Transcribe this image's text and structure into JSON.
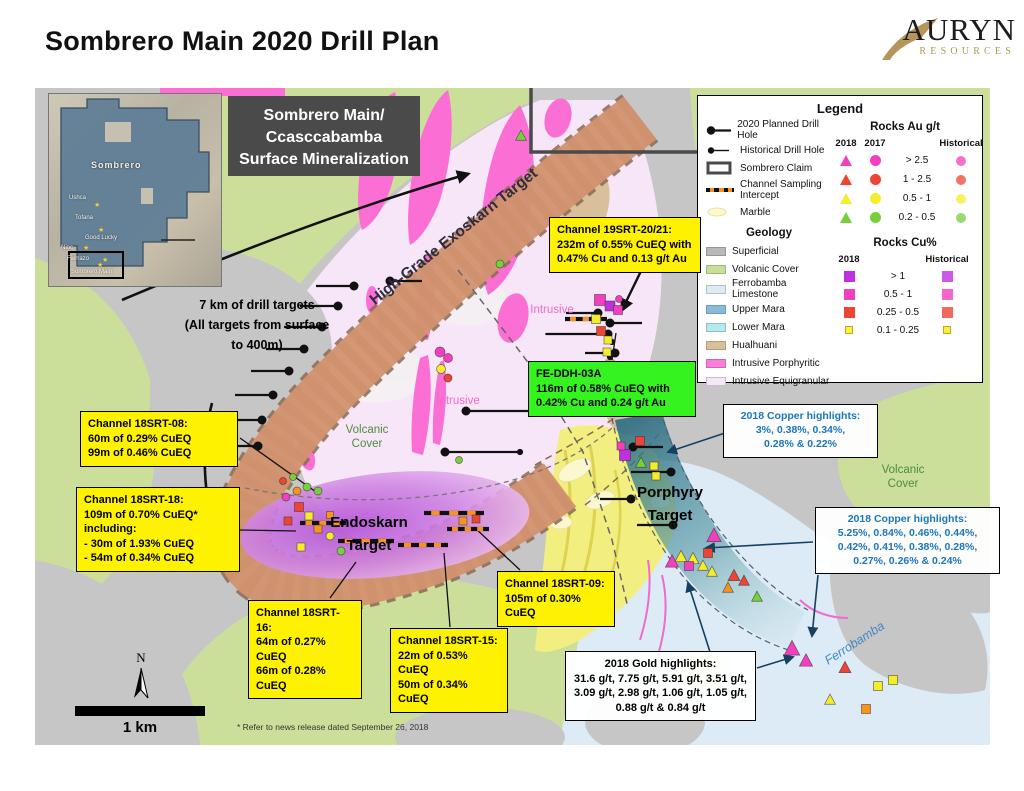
{
  "page": {
    "title": "Sombrero Main 2020 Drill Plan"
  },
  "logo": {
    "brand": "AURYN",
    "subtitle": "RESOURCES",
    "gold": "#b5955a"
  },
  "title_box": {
    "line1": "Sombrero Main/",
    "line2": "Ccasccabamba",
    "line3": "Surface Mineralization"
  },
  "inset": {
    "region": "Sombrero",
    "targets": [
      {
        "name": "Ushca",
        "lx": 20,
        "ly": 101,
        "sx": 45,
        "sy": 108
      },
      {
        "name": "Tofana",
        "lx": 26,
        "ly": 121,
        "sx": -1,
        "sy": -1
      },
      {
        "name": "Good Lucky",
        "lx": 36,
        "ly": 141,
        "sx": 49,
        "sy": 133
      },
      {
        "name": "Nioc",
        "lx": 12,
        "ly": 151,
        "sx": 34,
        "sy": 151
      },
      {
        "name": "Fierrazo",
        "lx": 18,
        "ly": 162,
        "sx": 53,
        "sy": 163
      },
      {
        "name": "Sombrero Main",
        "lx": 22,
        "ly": 175,
        "sx": 48,
        "sy": 168
      }
    ]
  },
  "legend": {
    "title": "Legend",
    "items": [
      {
        "label": "2020 Planned Drill Hole"
      },
      {
        "label": "Historical Drill Hole"
      },
      {
        "label": "Sombrero Claim"
      },
      {
        "label": "Channel Sampling Intercept"
      },
      {
        "label": "Marble"
      }
    ],
    "geology": {
      "title": "Geology",
      "items": [
        {
          "label": "Superficial",
          "color": "#b8b8b8"
        },
        {
          "label": "Volcanic Cover",
          "color": "#c9df97"
        },
        {
          "label": "Ferrobamba Limestone",
          "color": "#dcebf5"
        },
        {
          "label": "Upper Mara",
          "color": "#8abbdc"
        },
        {
          "label": "Lower Mara",
          "color": "#b5e8f0"
        },
        {
          "label": "Hualhuani",
          "color": "#d9c09b"
        },
        {
          "label": "Intrusive Porphyritic",
          "color": "#fb7edb"
        },
        {
          "label": "Intrusive Equigranular",
          "color": "#f7e6f8"
        }
      ]
    },
    "rocks_au": {
      "title": "Rocks Au g/t",
      "col_2018": "2018",
      "col_2017": "2017",
      "col_hist": "Historical",
      "rows": [
        {
          "range": "> 2.5",
          "color": "#f23fc0"
        },
        {
          "range": "1 - 2.5",
          "color": "#ee4433"
        },
        {
          "range": "0.5 - 1",
          "color": "#f6ee2c"
        },
        {
          "range": "0.2 - 0.5",
          "color": "#77cf3c"
        }
      ]
    },
    "rocks_cu": {
      "title": "Rocks Cu%",
      "col_2018": "2018",
      "col_hist": "Historical",
      "rows": [
        {
          "range": "> 1",
          "color": "#c02fe0"
        },
        {
          "range": "0.5 - 1",
          "color": "#f23fc0"
        },
        {
          "range": "0.25 - 0.5",
          "color": "#ee4433"
        },
        {
          "range": "0.1 - 0.25",
          "color": "#f6ee2c"
        }
      ]
    }
  },
  "callouts": {
    "ch19": {
      "lines": [
        "Channel 19SRT-20/21:",
        "232m of 0.55% CuEQ with",
        "0.47% Cu and 0.13 g/t Au"
      ]
    },
    "fe": {
      "lines": [
        "FE-DDH-03A",
        "116m of 0.58% CuEQ with",
        "0.42% Cu and 0.24 g/t Au"
      ]
    },
    "srt08": {
      "lines": [
        "Channel 18SRT-08:",
        "60m of 0.29% CuEQ",
        "99m of 0.46% CuEQ"
      ]
    },
    "srt18": {
      "lines": [
        "Channel 18SRT-18:",
        "109m of 0.70% CuEQ*",
        "including:",
        "- 30m of 1.93% CuEQ",
        "- 54m of 0.34% CuEQ"
      ]
    },
    "srt16": {
      "lines": [
        "Channel 18SRT-16:",
        "64m of 0.27% CuEQ",
        "66m of 0.28% CuEQ"
      ]
    },
    "srt15": {
      "lines": [
        "Channel 18SRT-15:",
        "22m of 0.53% CuEQ",
        "50m of 0.34% CuEQ"
      ]
    },
    "srt09": {
      "lines": [
        "Channel 18SRT-09:",
        "105m of 0.30% CuEQ"
      ]
    },
    "cu1": {
      "lines": [
        "2018 Copper highlights:",
        "3%, 0.38%, 0.34%,",
        "0.28% & 0.22%"
      ]
    },
    "cu2": {
      "lines": [
        "2018 Copper highlights:",
        "5.25%, 0.84%, 0.46%, 0.44%,",
        "0.42%, 0.41%, 0.38%, 0.28%,",
        "0.27%, 0.26% & 0.24%"
      ]
    },
    "gold": {
      "lines": [
        "2018 Gold highlights:",
        "31.6 g/t, 7.75 g/t, 5.91 g/t, 3.51 g/t,",
        "3.09 g/t, 2.98 g/t, 1.06 g/t, 1.05 g/t,",
        "0.88 g/t & 0.84 g/t"
      ]
    }
  },
  "annotations": {
    "note": {
      "lines": [
        "7 km of drill targets",
        "(All targets from surface",
        "to 400m)"
      ]
    },
    "exoskarn": "High-Grade Exoskarn Target",
    "endoskarn": {
      "lines": [
        "Endoskarn",
        "Target"
      ]
    },
    "porphyry": {
      "lines": [
        "Porphyry",
        "Target"
      ]
    },
    "volcanic": {
      "lines": [
        "Volcanic",
        "Cover"
      ]
    },
    "intrusive": "Intrusive",
    "ferrobamba": "Ferrobamba"
  },
  "scale": {
    "label": "1 km"
  },
  "north": {
    "label": "N"
  },
  "footnote": "* Refer to news release dated September 26, 2018",
  "map": {
    "palette": {
      "M": "#f23fc0",
      "R": "#ee4433",
      "Y": "#f5ec2e",
      "G": "#77cf3c",
      "P": "#c02fe0",
      "O": "#f7941d"
    },
    "drill_planned": [
      [
        354,
        286,
        316
      ],
      [
        338,
        306,
        300
      ],
      [
        322,
        327,
        284
      ],
      [
        304,
        349,
        266
      ],
      [
        289,
        371,
        251
      ],
      [
        273,
        395,
        235
      ],
      [
        262,
        420,
        224
      ],
      [
        258,
        446,
        220
      ],
      [
        390,
        281,
        422
      ],
      [
        466,
        411,
        560
      ],
      [
        445,
        452,
        521
      ],
      [
        598,
        313,
        566
      ],
      [
        610,
        323,
        642
      ],
      [
        608,
        334,
        546
      ],
      [
        615,
        353,
        585
      ],
      [
        633,
        447,
        663
      ],
      [
        671,
        472,
        631
      ],
      [
        631,
        499,
        600
      ],
      [
        673,
        525,
        637
      ]
    ],
    "drill_historical": [
      [
        612,
        342
      ],
      [
        610,
        357
      ],
      [
        607,
        372
      ],
      [
        520,
        452
      ]
    ],
    "channels": [
      [
        300,
        523,
        46
      ],
      [
        338,
        541,
        56
      ],
      [
        398,
        545,
        50
      ],
      [
        424,
        513,
        60
      ],
      [
        447,
        529,
        42
      ],
      [
        565,
        319,
        42
      ]
    ],
    "markers": [
      [
        "c",
        "G",
        318,
        491,
        8
      ],
      [
        "c",
        "O",
        297,
        491,
        8
      ],
      [
        "c",
        "G",
        307,
        487,
        8
      ],
      [
        "c",
        "M",
        286,
        497,
        8
      ],
      [
        "s",
        "R",
        299,
        507,
        9
      ],
      [
        "s",
        "Y",
        309,
        516,
        8
      ],
      [
        "s",
        "R",
        288,
        521,
        8
      ],
      [
        "s",
        "O",
        318,
        529,
        8
      ],
      [
        "c",
        "Y",
        330,
        536,
        8
      ],
      [
        "c",
        "G",
        341,
        551,
        8
      ],
      [
        "s",
        "Y",
        301,
        547,
        8
      ],
      [
        "c",
        "R",
        283,
        481,
        7
      ],
      [
        "c",
        "G",
        293,
        477,
        7
      ],
      [
        "s",
        "O",
        330,
        515,
        7
      ],
      [
        "c",
        "M",
        440,
        352,
        10
      ],
      [
        "c",
        "M",
        448,
        358,
        9
      ],
      [
        "c",
        "Y",
        441,
        369,
        9
      ],
      [
        "c",
        "R",
        448,
        378,
        8
      ],
      [
        "s",
        "M",
        600,
        300,
        11
      ],
      [
        "s",
        "P",
        610,
        306,
        10
      ],
      [
        "s",
        "M",
        618,
        310,
        9
      ],
      [
        "s",
        "Y",
        596,
        319,
        9
      ],
      [
        "s",
        "R",
        601,
        331,
        9
      ],
      [
        "s",
        "Y",
        608,
        340,
        8
      ],
      [
        "s",
        "Y",
        607,
        352,
        8
      ],
      [
        "s",
        "Y",
        610,
        364,
        8
      ],
      [
        "c",
        "M",
        619,
        299,
        7
      ],
      [
        "s",
        "P",
        625,
        455,
        11
      ],
      [
        "s",
        "R",
        640,
        441,
        9
      ],
      [
        "t",
        "G",
        641,
        463,
        9
      ],
      [
        "s",
        "Y",
        654,
        466,
        8
      ],
      [
        "s",
        "Y",
        656,
        476,
        8
      ],
      [
        "s",
        "M",
        621,
        446,
        8
      ],
      [
        "t",
        "M",
        714,
        536,
        12
      ],
      [
        "t",
        "Y",
        681,
        557,
        10
      ],
      [
        "t",
        "Y",
        693,
        559,
        10
      ],
      [
        "t",
        "M",
        672,
        562,
        11
      ],
      [
        "t",
        "Y",
        703,
        566,
        9
      ],
      [
        "s",
        "R",
        708,
        553,
        9
      ],
      [
        "t",
        "Y",
        712,
        572,
        9
      ],
      [
        "t",
        "R",
        734,
        576,
        10
      ],
      [
        "t",
        "R",
        744,
        581,
        9
      ],
      [
        "s",
        "M",
        689,
        566,
        9
      ],
      [
        "t",
        "G",
        757,
        597,
        9
      ],
      [
        "t",
        "O",
        728,
        588,
        9
      ],
      [
        "t",
        "M",
        792,
        649,
        13
      ],
      [
        "t",
        "M",
        806,
        661,
        11
      ],
      [
        "t",
        "R",
        845,
        668,
        10
      ],
      [
        "s",
        "Y",
        878,
        686,
        9
      ],
      [
        "s",
        "Y",
        893,
        680,
        9
      ],
      [
        "t",
        "Y",
        830,
        700,
        9
      ],
      [
        "s",
        "O",
        866,
        709,
        9
      ],
      [
        "t",
        "G",
        521,
        136,
        9
      ],
      [
        "c",
        "G",
        500,
        264,
        8
      ],
      [
        "c",
        "G",
        459,
        460,
        7
      ],
      [
        "s",
        "O",
        463,
        521,
        8
      ],
      [
        "s",
        "R",
        476,
        519,
        8
      ]
    ]
  }
}
